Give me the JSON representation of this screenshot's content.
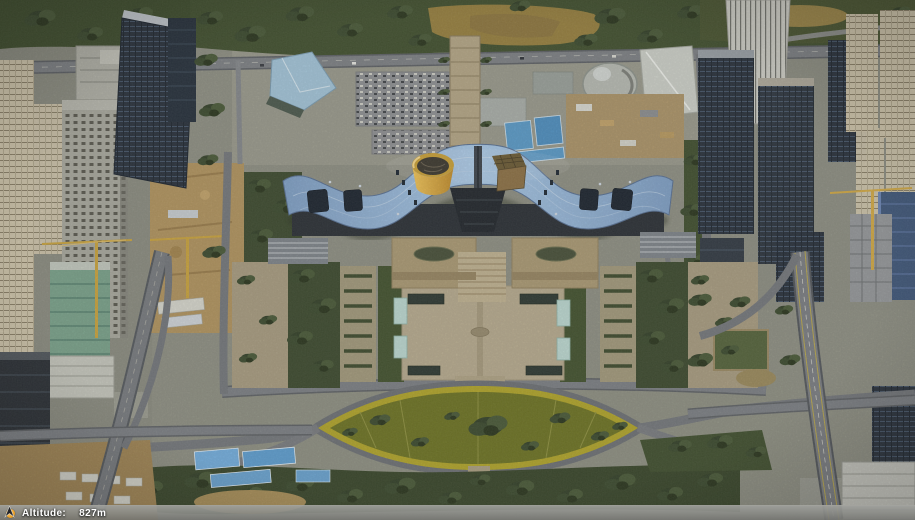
{
  "status_bar": {
    "altitude_label": "Altitude:",
    "altitude_value": "827m"
  },
  "icons": {
    "status_dot": "status-dot-icon",
    "north_arrow": "north-arrow-icon"
  },
  "palette": {
    "roof_blue": "#8fb3d9",
    "cylinder_yellow": "#e7b648",
    "cube_brown": "#8d7246",
    "lawn_olive": "#6e7424",
    "lawn_ring_yellow": "#b1a52b",
    "forest_green": "#42512f",
    "road_gray": "#7b7e82",
    "plaza_tan": "#b7ab8e",
    "construction_tan": "#b1945f",
    "dark_glass_tower": "#2a323c",
    "cream_tower": "#cfc5ab",
    "status_bar_gray": "#85868a",
    "status_text": "#ffffff",
    "status_accent": "#e8a02c"
  }
}
